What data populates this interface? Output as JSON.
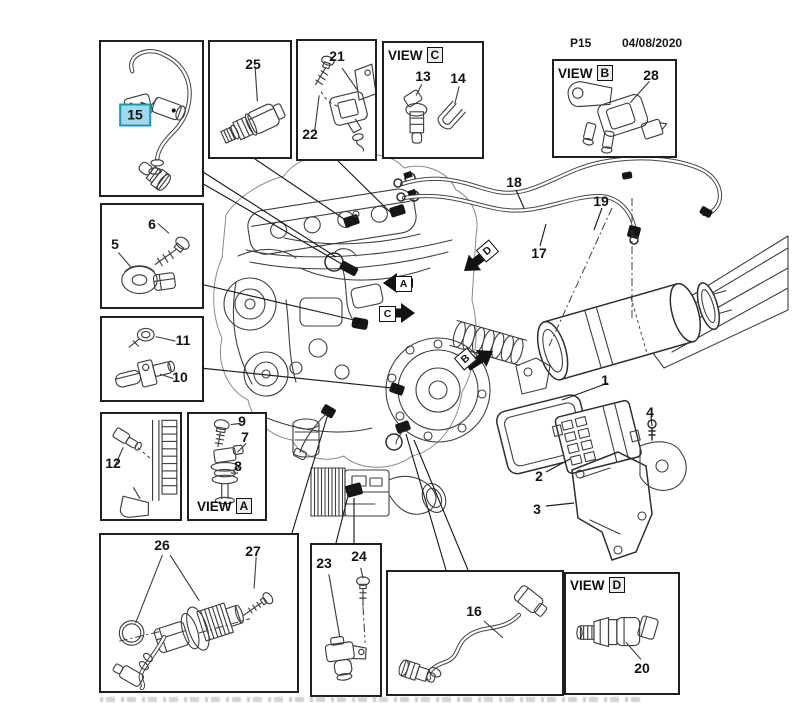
{
  "header": {
    "page_code": "P15",
    "date": "04/08/2020"
  },
  "view_word": "VIEW",
  "views": {
    "a": "A",
    "b": "B",
    "c": "C",
    "d": "D"
  },
  "arrows": {
    "a": "A",
    "b": "B",
    "c": "C",
    "d": "D"
  },
  "callouts": {
    "c1": "1",
    "c2": "2",
    "c3": "3",
    "c4": "4",
    "c5": "5",
    "c6": "6",
    "c7": "7",
    "c8": "8",
    "c9": "9",
    "c10": "10",
    "c11": "11",
    "c12": "12",
    "c13": "13",
    "c14": "14",
    "c15": "15",
    "c16": "16",
    "c17": "17",
    "c18": "18",
    "c19": "19",
    "c20": "20",
    "c21": "21",
    "c22": "22",
    "c23": "23",
    "c24": "24",
    "c25": "25",
    "c26": "26",
    "c27": "27",
    "c28": "28"
  },
  "highlight": {
    "selected_callout": "15",
    "bg": "#9fd9ec",
    "border": "#1b97ba"
  },
  "colors": {
    "line": "#3f3f3f",
    "ink": "#141414"
  }
}
